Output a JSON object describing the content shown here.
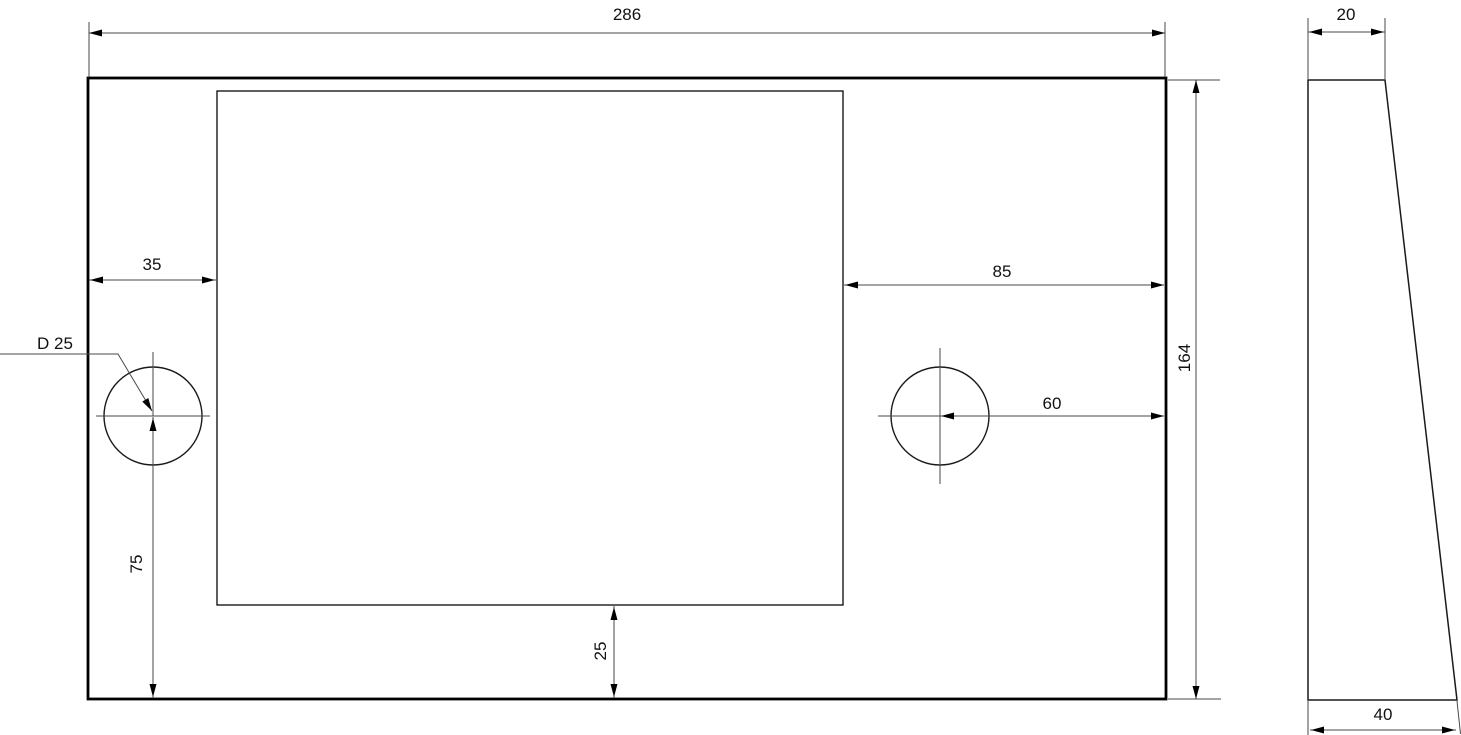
{
  "drawing": {
    "kind": "2D CAD technical drawing, plate with rectangular pocket and two holes",
    "background": "#ffffff",
    "colors": {
      "outline": "#000000",
      "dimension_line": "#4a4a4a",
      "text": "#111111"
    }
  },
  "dimensions": {
    "overall_width": {
      "label": "286",
      "value": 286
    },
    "overall_height": {
      "label": "164",
      "value": 164
    },
    "pocket_from_left": {
      "label": "35",
      "value": 35
    },
    "pocket_from_right": {
      "label": "85",
      "value": 85
    },
    "pocket_from_bottom": {
      "label": "25",
      "value": 25
    },
    "hole_diameter": {
      "label": "D 25",
      "value": 25
    },
    "left_hole_from_bottom": {
      "label": "75",
      "value": 75
    },
    "right_hole_from_right": {
      "label": "60",
      "value": 60
    },
    "side_top_width": {
      "label": "20",
      "value": 20
    },
    "side_bottom_width": {
      "label": "40",
      "value": 40
    }
  }
}
